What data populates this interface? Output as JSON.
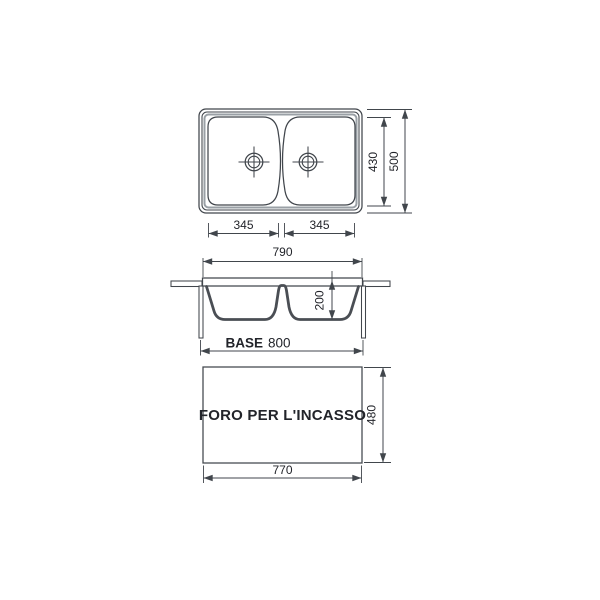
{
  "colors": {
    "line": "#41464c",
    "section_line": "#4a4e54",
    "text": "#22242a",
    "shade": "#9aa0a6",
    "background": "#ffffff"
  },
  "plan_view": {
    "dim_bowl_left_width": "345",
    "dim_bowl_right_width": "345",
    "dim_inner_length": "430",
    "dim_overall_length": "500"
  },
  "section_view": {
    "dim_overall_width": "790",
    "dim_bowl_depth": "200",
    "base_label": "BASE",
    "base_value": "800"
  },
  "cutout_view": {
    "label": "FORO PER L'INCASSO",
    "dim_width": "770",
    "dim_height": "480"
  }
}
